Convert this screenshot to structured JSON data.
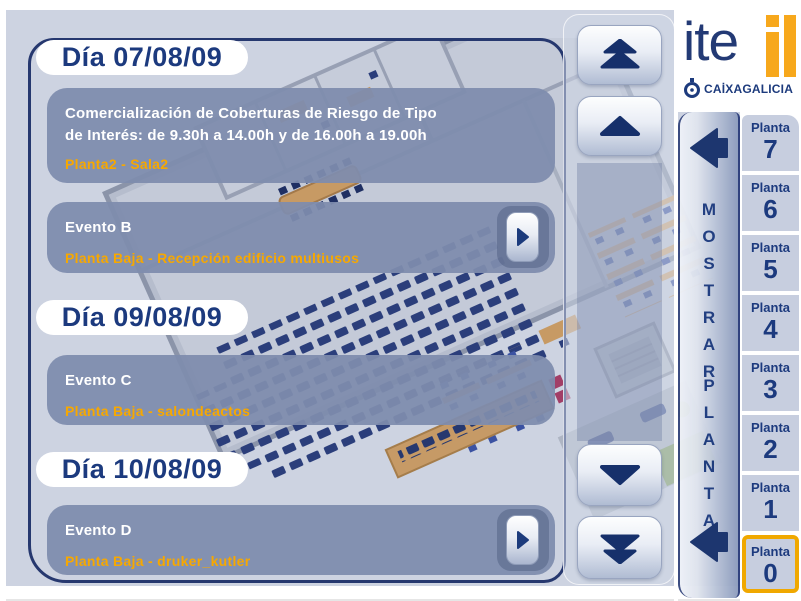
{
  "window": {
    "background": "#cdd3e1",
    "panel_border": "#26386f"
  },
  "colors": {
    "navy": "#1c3a7e",
    "orange": "#f7a800",
    "event_box": "#7e8cad",
    "highlight_border": "#f0a800",
    "floor_button_bg": "#c7cedf"
  },
  "logo": {
    "wordmark": "ite",
    "brand": "CAİXAGALICIA",
    "mark_icon": "itel-yellow-mark",
    "brand_icon": "caixa-swirl-icon"
  },
  "days": [
    {
      "date": "Día 07/08/09",
      "events": [
        {
          "title": "Comercialización de Coberturas de Riesgo de Tipo",
          "title2": "de Interés: de 9.30h a 14.00h y de 16.00h a 19.00h",
          "location": "Planta2 - Sala2",
          "has_detail_arrow": false
        },
        {
          "title": "Evento B",
          "title2": "",
          "location": "Planta Baja - Recepción edificio multiusos",
          "has_detail_arrow": true
        }
      ]
    },
    {
      "date": "Día 09/08/09",
      "events": [
        {
          "title": "Evento C",
          "title2": "",
          "location": "Planta Baja - salondeactos",
          "has_detail_arrow": false
        }
      ]
    },
    {
      "date": "Día 10/08/09",
      "events": [
        {
          "title": "Evento D",
          "title2": "",
          "location": "Planta Baja - druker_kutler",
          "has_detail_arrow": true
        }
      ]
    }
  ],
  "scrollbar": {
    "icons": [
      "double-chevron-up",
      "chevron-up",
      "chevron-down",
      "double-chevron-down"
    ]
  },
  "show_floor_bar": {
    "word1": "MOSTRAR",
    "word2": "PLANTA",
    "icons": [
      "arrow-left",
      "arrow-left"
    ]
  },
  "floors": [
    {
      "label": "Planta",
      "number": "7",
      "selected": false
    },
    {
      "label": "Planta",
      "number": "6",
      "selected": false
    },
    {
      "label": "Planta",
      "number": "5",
      "selected": false
    },
    {
      "label": "Planta",
      "number": "4",
      "selected": false
    },
    {
      "label": "Planta",
      "number": "3",
      "selected": false
    },
    {
      "label": "Planta",
      "number": "2",
      "selected": false
    },
    {
      "label": "Planta",
      "number": "1",
      "selected": false
    },
    {
      "label": "Planta",
      "number": "0",
      "selected": true
    }
  ]
}
